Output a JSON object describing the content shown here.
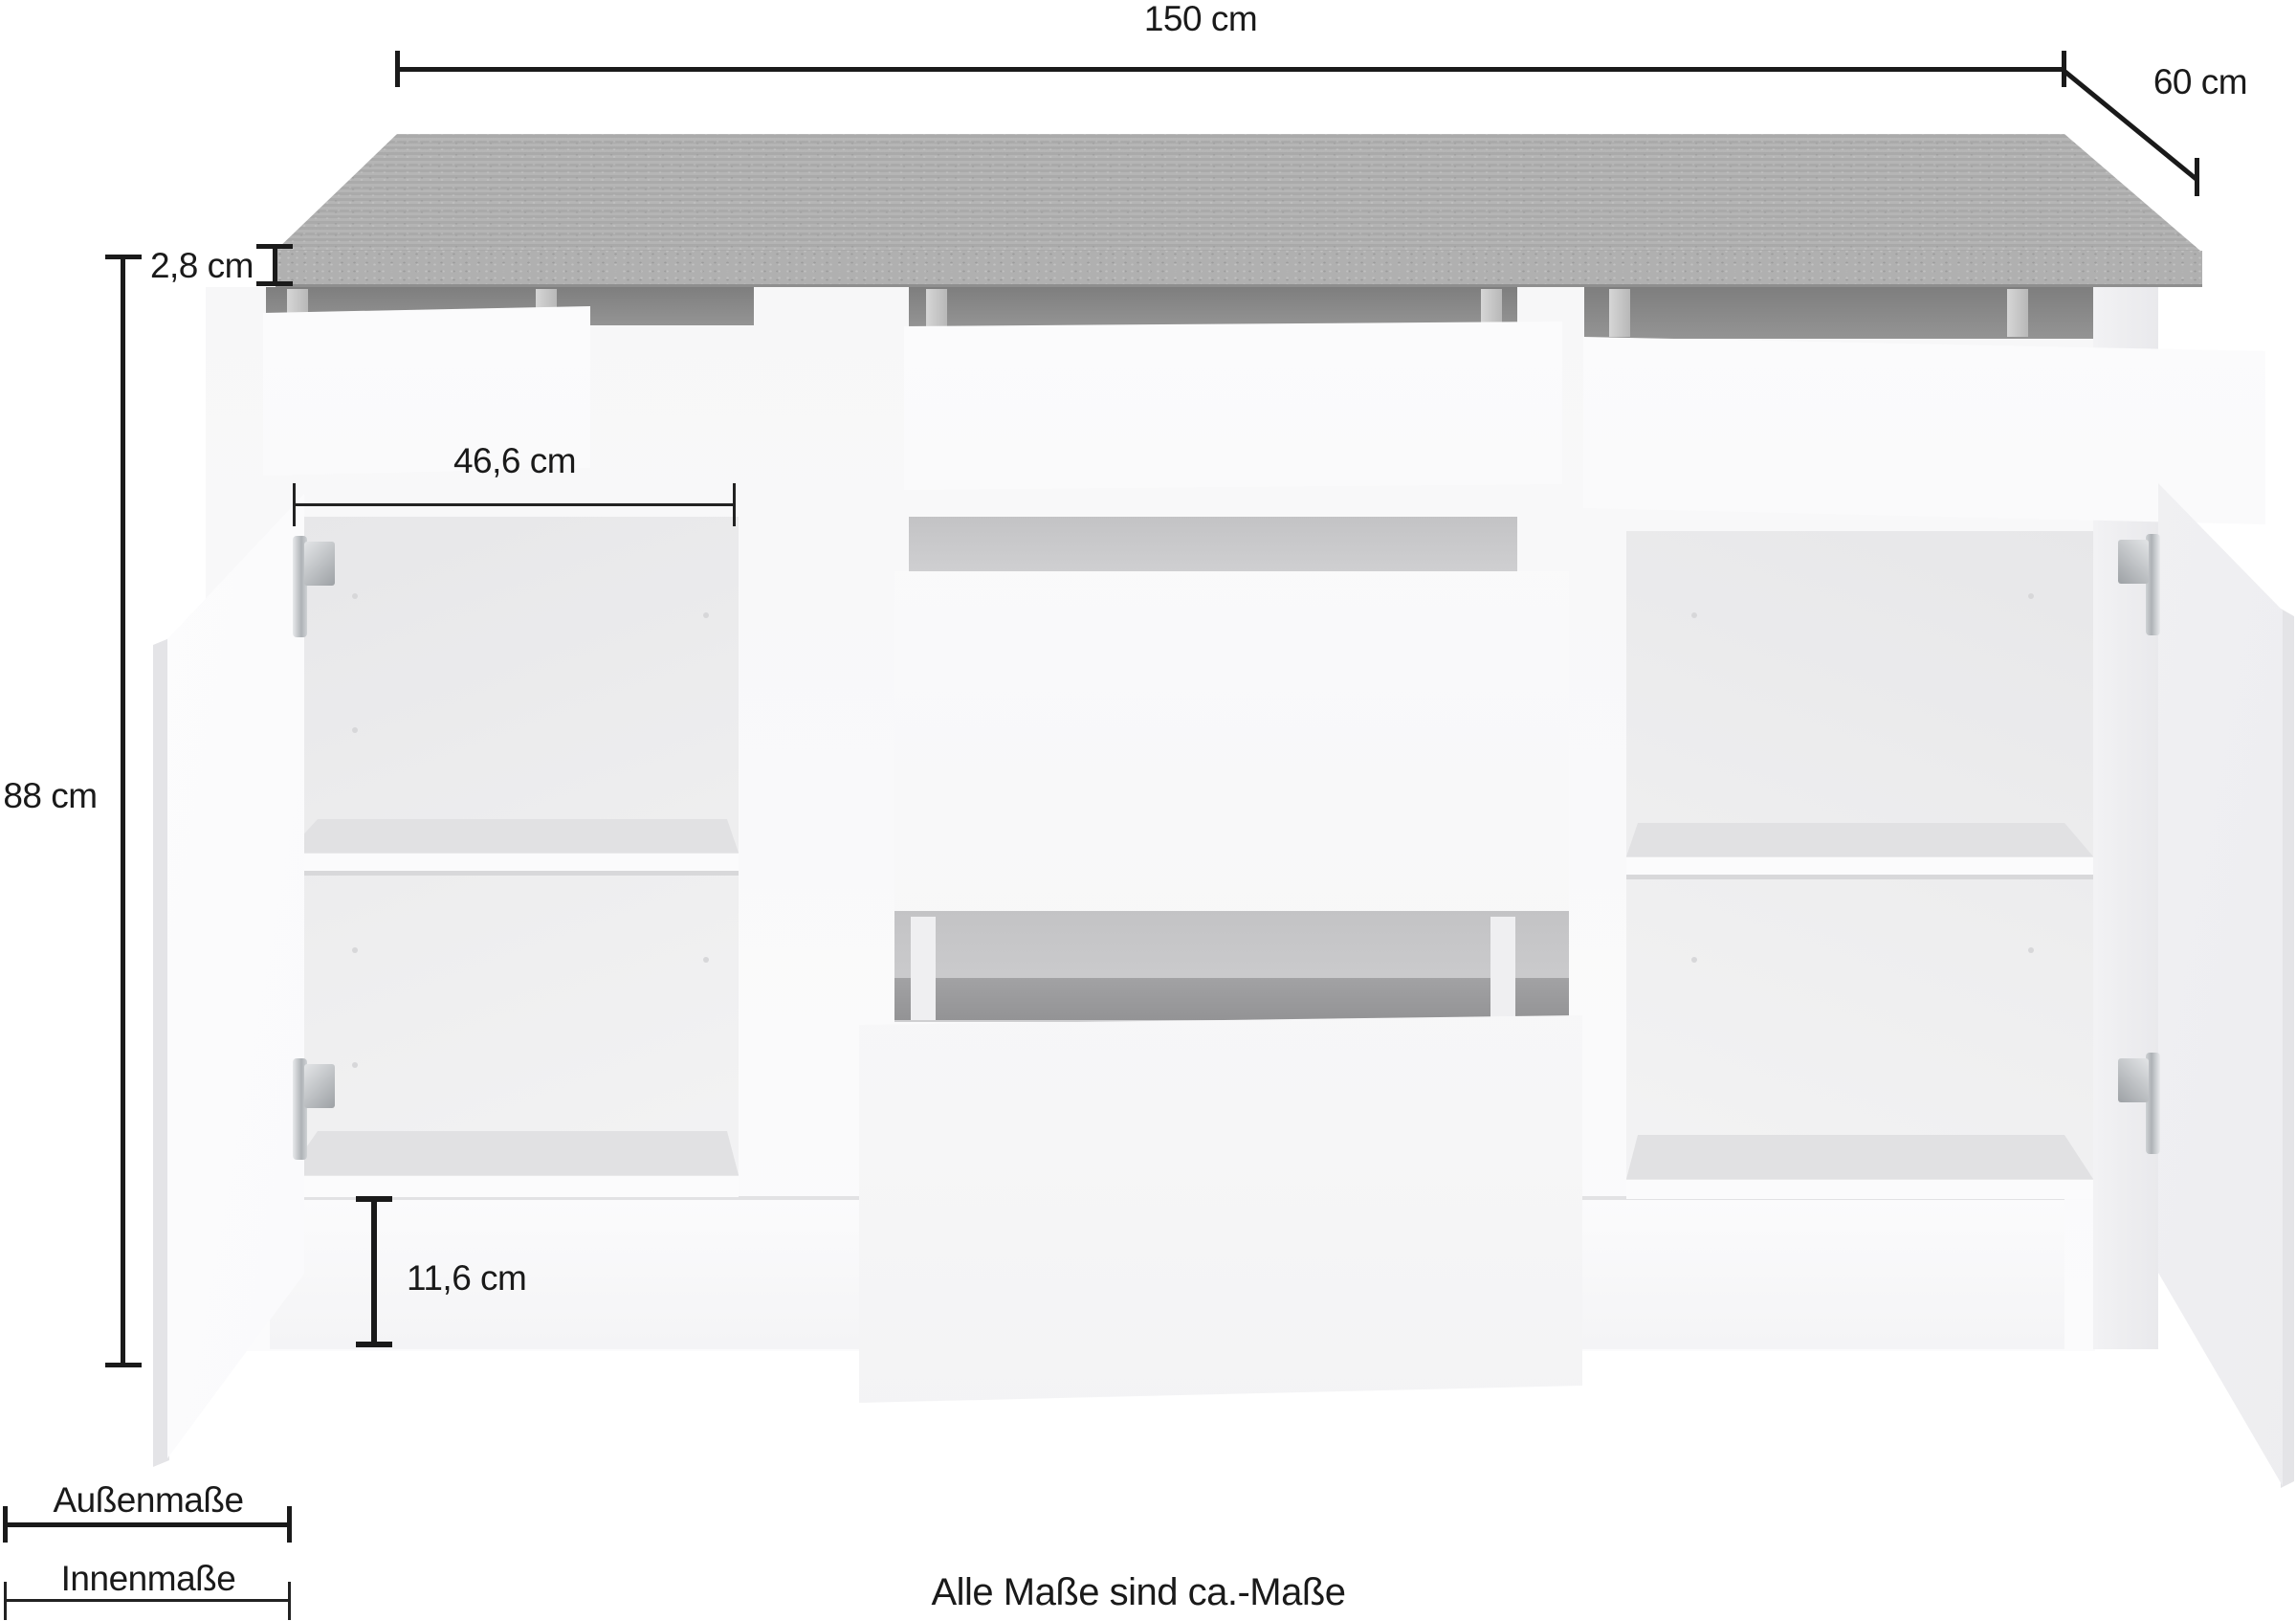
{
  "measurements": [
    {
      "id": "total-width",
      "label": "150 cm"
    },
    {
      "id": "depth",
      "label": "60 cm"
    },
    {
      "id": "worktop-thickness",
      "label": "2,8 cm"
    },
    {
      "id": "height",
      "label": "88 cm"
    },
    {
      "id": "inner-width",
      "label": "46,6 cm"
    },
    {
      "id": "plinth-height",
      "label": "11,6 cm"
    }
  ],
  "legend": {
    "outer_label": "Außenmaße",
    "inner_label": "Innenmaße"
  },
  "footnote": "Alle Maße sind ca.-Maße",
  "colors": {
    "annotation": "#1a1a1a",
    "worktop_top": "#aaaaaa",
    "worktop_front": "#adadad",
    "body_white": "#f8f8f9",
    "cavity_dark": "#8d8d8d",
    "interior_gray": "#ececee",
    "hinge_chrome": "#b5b8bb"
  }
}
